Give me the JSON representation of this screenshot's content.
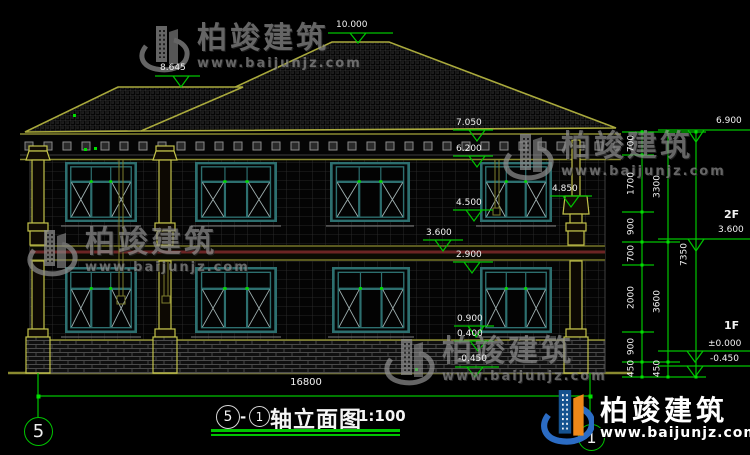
{
  "drawing_title": {
    "axis_left": "5",
    "separator": "-",
    "axis_right": "1",
    "name": "轴立面图",
    "scale": "1:100"
  },
  "axes": {
    "left_bubble": "5",
    "right_bubble": "1"
  },
  "levels_left": [
    "10.000",
    "8.645",
    "7.050",
    "6.200",
    "4.850",
    "4.500",
    "3.600",
    "2.900",
    "0.900",
    "0.400",
    "-0.450"
  ],
  "levels_right": {
    "eave": "6.900",
    "floor2": "3.600",
    "zero": "±0.000",
    "ground": "-0.450",
    "floor2_label": "2F",
    "floor1_label": "1F"
  },
  "dimensions": {
    "chain_inner": [
      "700",
      "1700",
      "900",
      "700",
      "2000",
      "900",
      "450"
    ],
    "chain_middle": [
      "3300",
      "3600",
      "450"
    ],
    "chain_outer": [
      "7350"
    ],
    "total_width": "16800"
  },
  "watermark": {
    "brand": "柏竣建筑",
    "site": "www.baijunjz.com"
  },
  "footer_logo": {
    "brand": "柏竣建筑",
    "site": "www.baijunjz.com"
  },
  "colors": {
    "dim_green": "#00c400",
    "line_olive": "#8a8a30",
    "window_teal": "#2d6f6f",
    "logo_blue": "#2b6cc4",
    "logo_orange": "#ef8818"
  }
}
